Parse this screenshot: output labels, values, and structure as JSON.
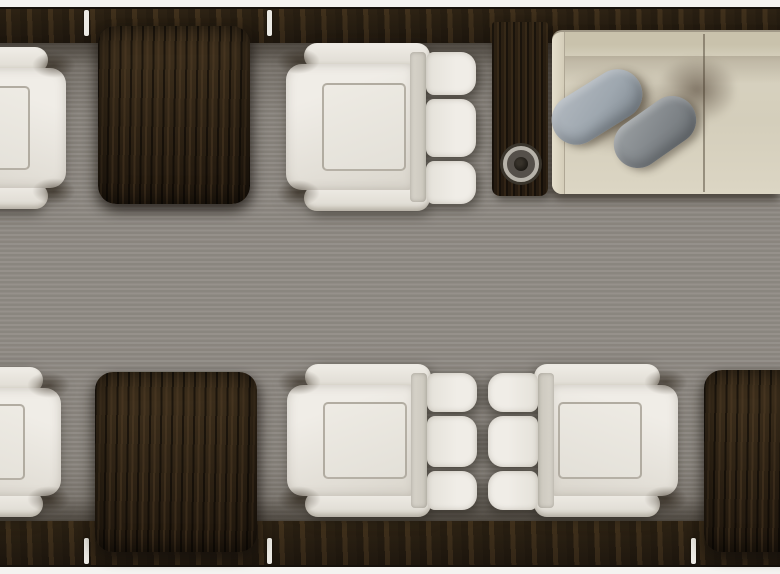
{
  "scene": {
    "type": "private-jet-cabin-top-view-render",
    "view": "top-down",
    "areas": {
      "forward_left": "club seat and wood pedestal table",
      "forward_center": "single club seat",
      "forward_right": "divan with side cabinet, cupholder and two throw pillows",
      "aft": "two facing club seats flanked by wood tables",
      "aisle": "striped grey carpet",
      "walls": "dark wood sidewall ledges with white window posts"
    }
  },
  "furniture": {
    "club_seats_full": 3,
    "club_seats_partial": 2,
    "wood_tables": 3,
    "divan_cushion_sections": 2,
    "throw_pillows": 2,
    "cupholders": 1,
    "window_posts_top": 2,
    "window_posts_bottom": 3
  },
  "labels": {
    "cabin": "Private jet cabin top view",
    "carpet": "Cabin aisle carpet",
    "sidewall": "Dark wood sidewall ledge",
    "window_post": "Window post",
    "table": "High-gloss wood table",
    "seat": "Ivory leather club seat",
    "cabinet": "Side cabinet with cupholder",
    "cupholder": "Cupholder",
    "divan": "Cream leather divan",
    "pillow_light": "Light grey throw pillow",
    "pillow_dark": "Dark grey throw pillow"
  },
  "colors": {
    "fuselage_trim": "#f4f3f0",
    "trim_line": "#17120c",
    "sidewall_wood": "#281e12",
    "sidewall_grain": "#3a2c19",
    "window_post": "#eceae4",
    "carpet_light": "#8f8a84",
    "carpet_dark": "#837e77",
    "seat_leather_light": "#f0ede7",
    "seat_leather_dark": "#dcd8cf",
    "table_wood_light": "#3b2d1b",
    "table_wood_dark": "#20170d",
    "cabinet_wood": "#241a10",
    "cupholder_ring": "#b7b3aa",
    "cupholder_well": "#1c1914",
    "divan_leather": "#d8d2c0",
    "divan_leather_dark": "#c9c2ac",
    "divan_arm": "#e5dfcc",
    "divan_seam_c": "#5f5646",
    "pillow_light_c": "#9ea7af",
    "pillow_light_hi": "#afb6bd",
    "pillow_dark_c": "#84898d",
    "pillow_dark_deep": "#6f7478"
  }
}
